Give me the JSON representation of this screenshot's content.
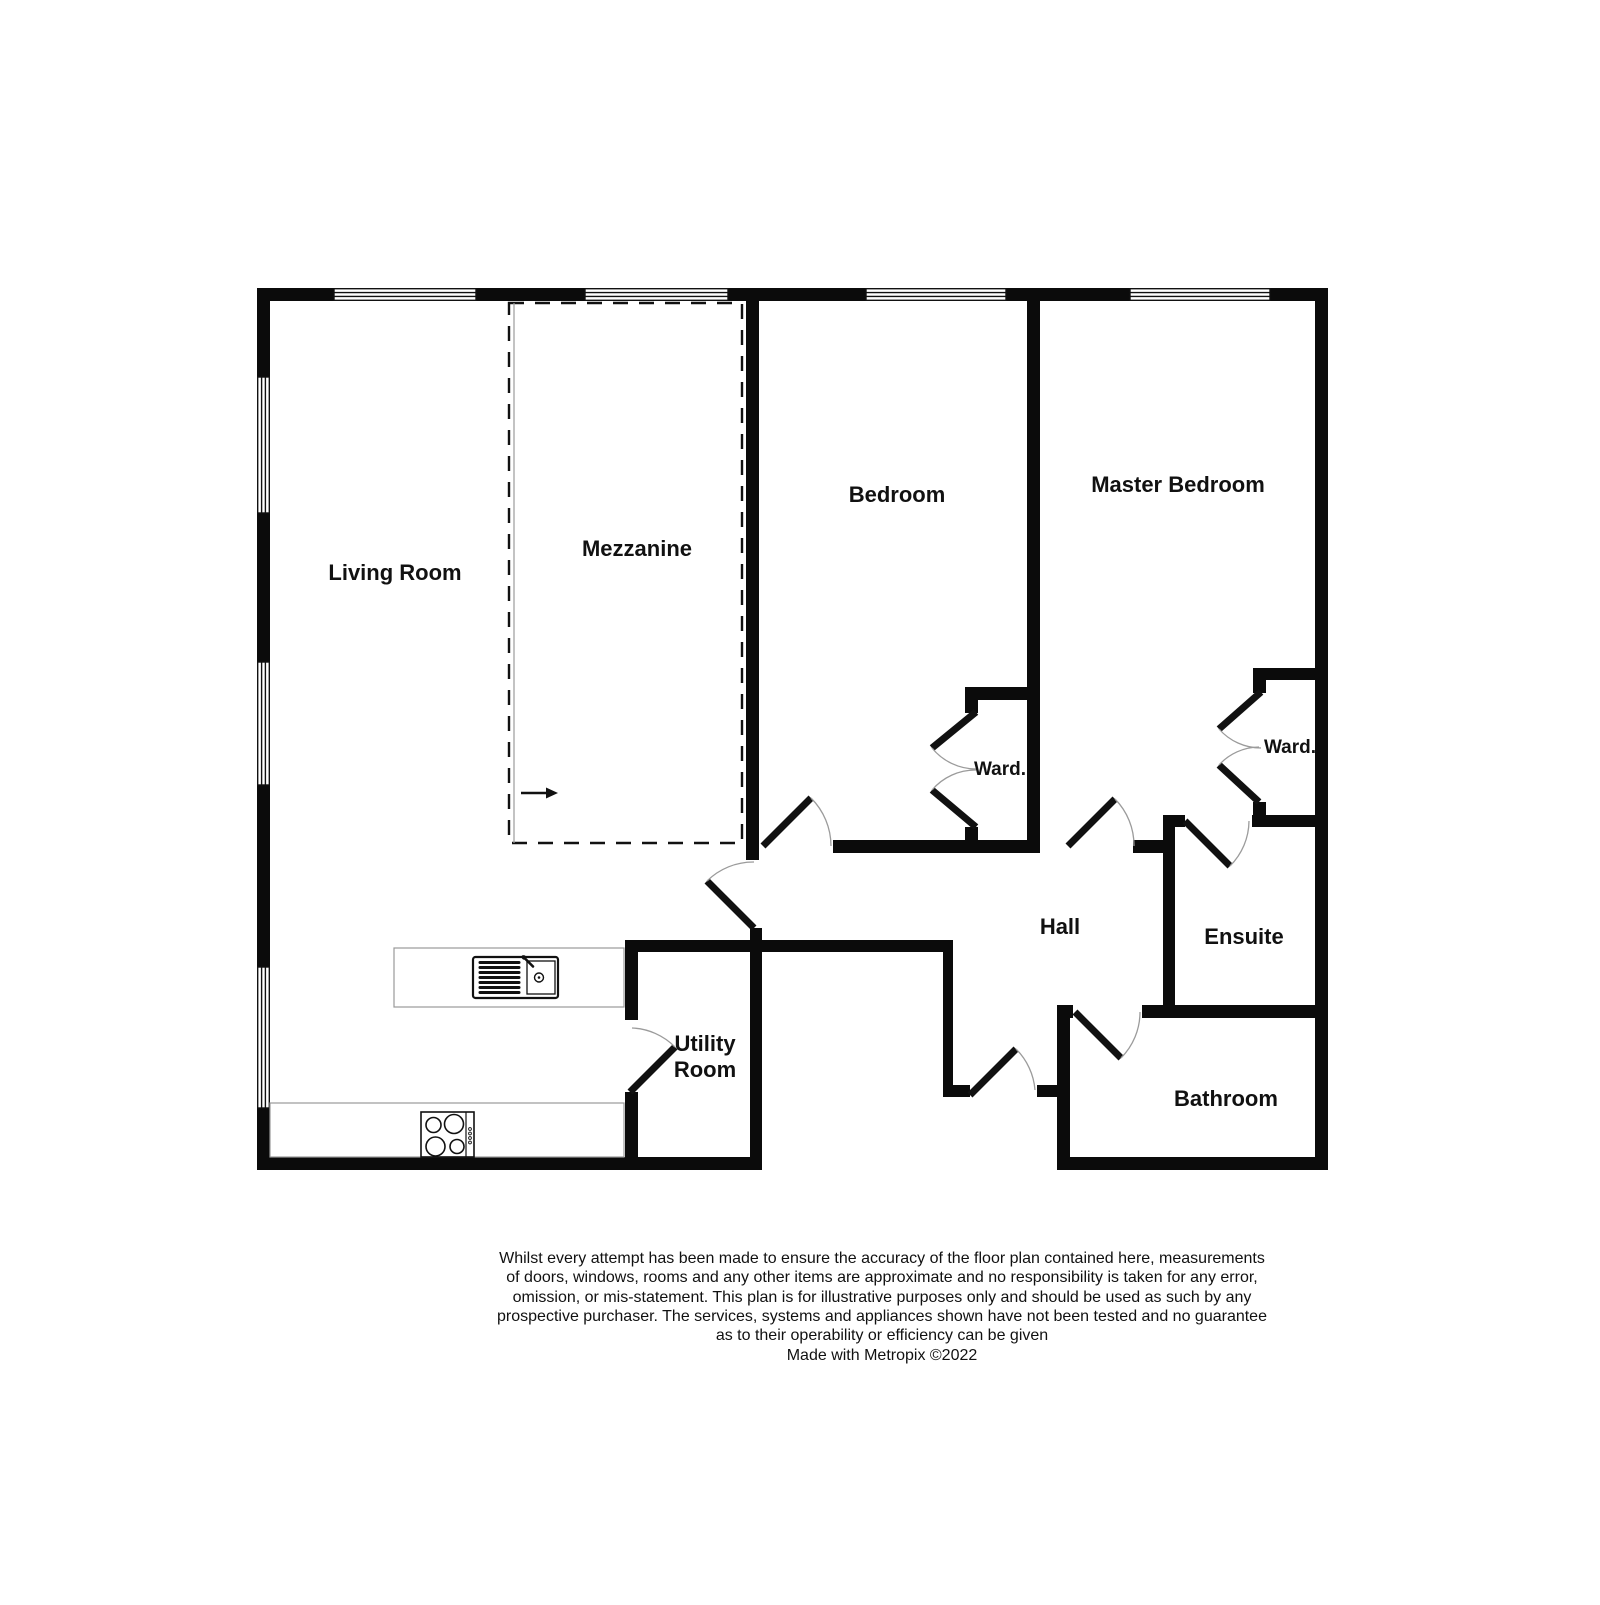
{
  "colors": {
    "wall": "#0b0b0b",
    "line": "#111111",
    "arc": "#9b9b9b",
    "counter_outline": "#999999",
    "background": "#ffffff",
    "text": "#111111"
  },
  "rooms": {
    "living_room": "Living Room",
    "mezzanine": "Mezzanine",
    "bedroom": "Bedroom",
    "master_bedroom": "Master Bedroom",
    "wardrobe_abbrev": "Ward.",
    "hall": "Hall",
    "ensuite": "Ensuite",
    "utility_line1": "Utility",
    "utility_line2": "Room",
    "bathroom": "Bathroom"
  },
  "fixtures": {
    "sink": "kitchen-sink",
    "hob": "four-ring-hob",
    "stairs_arrow": "stairs-direction-arrow"
  },
  "disclaimer": {
    "lines": [
      "Whilst every attempt has been made to ensure the accuracy of the floor plan contained here, measurements",
      "of doors, windows, rooms and any other items are approximate and no responsibility is taken for any error,",
      "omission, or mis-statement. This plan is for illustrative purposes only and should be used as such by any",
      "prospective purchaser. The services, systems and appliances shown have not been tested and no guarantee",
      "as to their operability or efficiency can be given"
    ],
    "credit": "Made with Metropix ©2022"
  }
}
